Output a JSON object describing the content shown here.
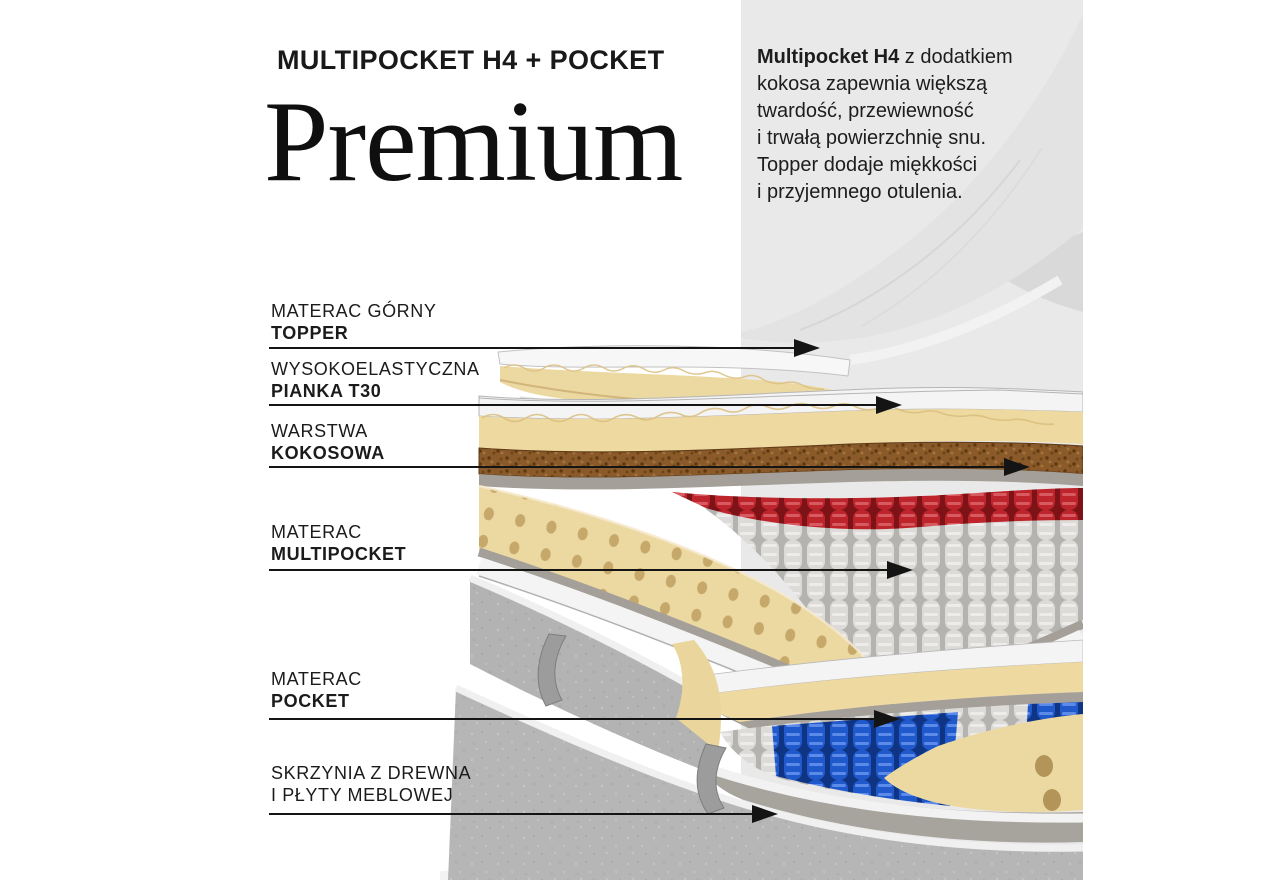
{
  "header": {
    "eyebrow": "MULTIPOCKET H4 + POCKET",
    "title": "Premium"
  },
  "description": {
    "lead": "Multipocket H4",
    "body": " z dodatkiem\nkokosa zapewnia większą\ntwardość, przewiewność\ni trwałą powierzchnię snu.\nTopper dodaje miękkości\ni przyjemnego otulenia."
  },
  "labels": [
    {
      "line1": "MATERAC GÓRNY",
      "line2": "TOPPER"
    },
    {
      "line1": "WYSOKOELASTYCZNA",
      "line2": "PIANKA T30"
    },
    {
      "line1": "WARSTWA",
      "line2": "KOKOSOWA"
    },
    {
      "line1": "MATERAC",
      "line2": "MULTIPOCKET"
    },
    {
      "line1": "MATERAC",
      "line2": "POCKET"
    },
    {
      "line1": "SKRZYNIA Z DREWNA",
      "line2": "I PŁYTY MEBLOWEJ"
    }
  ],
  "colors": {
    "background": "#ffffff",
    "backdrop": "#e9e9e9",
    "text": "#1b1b1b",
    "foam_cream": "#ecd9a2",
    "coconut_brown": "#8a5a2b",
    "springs_red": "#bd242c",
    "springs_white": "#dcdbd8",
    "springs_blue": "#2059cb",
    "fabric_gray": "#b5b5b5",
    "arrow_black": "#141414"
  }
}
